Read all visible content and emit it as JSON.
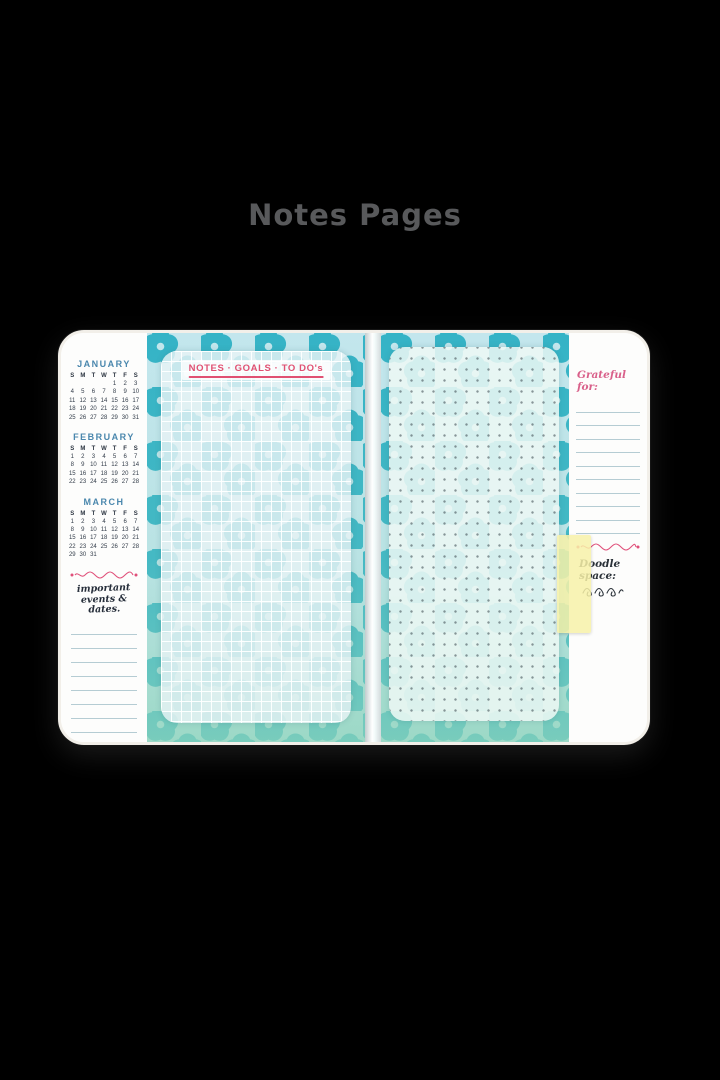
{
  "page": {
    "title": "Notes Pages",
    "background_color": "#000000",
    "title_color": "#58595B"
  },
  "notebook": {
    "left_page": {
      "months": [
        {
          "name": "JANUARY",
          "day_headers": [
            "S",
            "M",
            "T",
            "W",
            "T",
            "F",
            "S"
          ],
          "weeks": [
            [
              "",
              "",
              "",
              "",
              "1",
              "2",
              "3"
            ],
            [
              "4",
              "5",
              "6",
              "7",
              "8",
              "9",
              "10"
            ],
            [
              "11",
              "12",
              "13",
              "14",
              "15",
              "16",
              "17"
            ],
            [
              "18",
              "19",
              "20",
              "21",
              "22",
              "23",
              "24"
            ],
            [
              "25",
              "26",
              "27",
              "28",
              "29",
              "30",
              "31"
            ]
          ]
        },
        {
          "name": "FEBRUARY",
          "day_headers": [
            "S",
            "M",
            "T",
            "W",
            "T",
            "F",
            "S"
          ],
          "weeks": [
            [
              "1",
              "2",
              "3",
              "4",
              "5",
              "6",
              "7"
            ],
            [
              "8",
              "9",
              "10",
              "11",
              "12",
              "13",
              "14"
            ],
            [
              "15",
              "16",
              "17",
              "18",
              "19",
              "20",
              "21"
            ],
            [
              "22",
              "23",
              "24",
              "25",
              "26",
              "27",
              "28"
            ]
          ]
        },
        {
          "name": "MARCH",
          "day_headers": [
            "S",
            "M",
            "T",
            "W",
            "T",
            "F",
            "S"
          ],
          "weeks": [
            [
              "1",
              "2",
              "3",
              "4",
              "5",
              "6",
              "7"
            ],
            [
              "8",
              "9",
              "10",
              "11",
              "12",
              "13",
              "14"
            ],
            [
              "15",
              "16",
              "17",
              "18",
              "19",
              "20",
              "21"
            ],
            [
              "22",
              "23",
              "24",
              "25",
              "26",
              "27",
              "28"
            ],
            [
              "29",
              "30",
              "31",
              "",
              "",
              "",
              ""
            ]
          ]
        }
      ],
      "events_heading": "important events & dates.",
      "events_line_count": 9
    },
    "divider": {
      "notes_label": "NOTES · GOALS · TO DO's",
      "flower_color": "#35B3C6",
      "pattern_background": "#C3E6ED",
      "bottom_tint": "#8FD4B9",
      "accent_pink": "#E0507A"
    },
    "right_page": {
      "grateful_heading": "Grateful for:",
      "grateful_line_count": 10,
      "doodle_heading": "Doodle space:",
      "tab_color": "#F7F1A8"
    }
  }
}
